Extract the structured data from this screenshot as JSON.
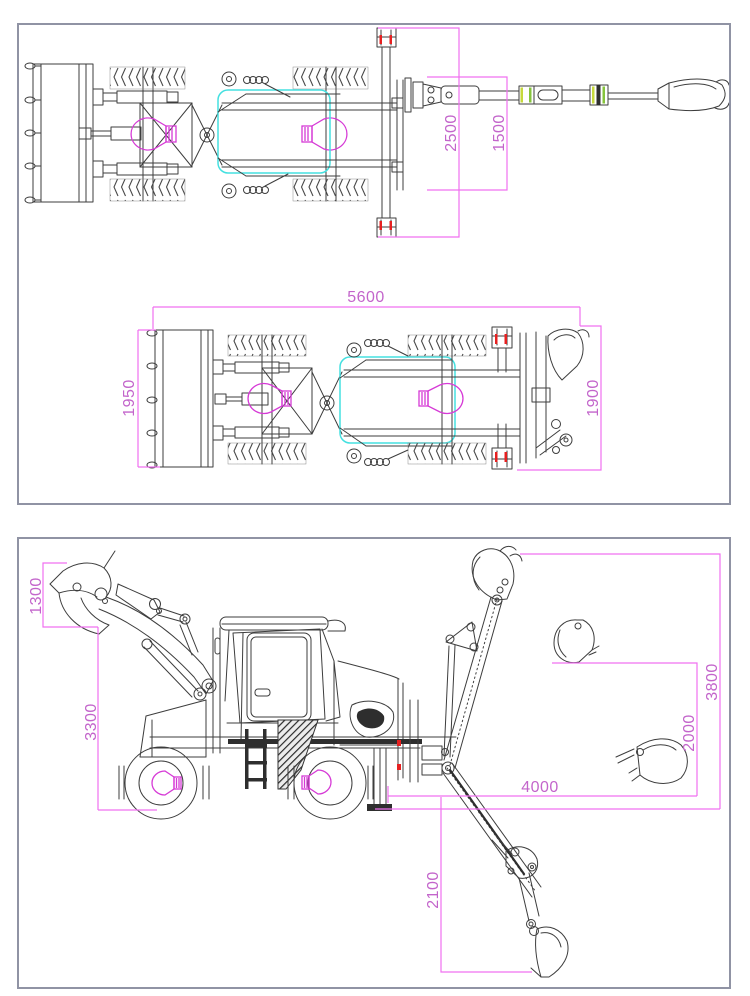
{
  "colors": {
    "dimension_line": "#f070f0",
    "dimension_text": "#c365cb",
    "machine_line": "#3d3d3d",
    "highlight_box_cyan": "#45e0e0",
    "axle_marker_magenta": "#d63ad6",
    "accent_red": "#e62020",
    "accent_yellow_green": "#c6d93c",
    "panel_border": "#9093a4"
  },
  "panels": {
    "plan": {
      "extended_view": {
        "dims": [
          "2500",
          "1500"
        ]
      },
      "transport_view": {
        "dims": [
          "5600",
          "1950",
          "1900"
        ]
      }
    },
    "side": {
      "dims": [
        "1300",
        "3300",
        "3800",
        "2000",
        "4000",
        "2100"
      ]
    }
  }
}
